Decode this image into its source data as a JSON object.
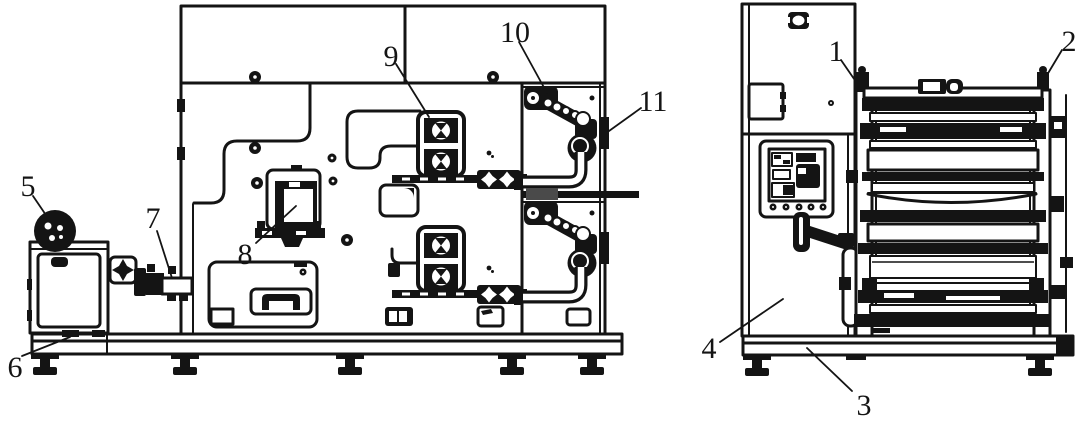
{
  "figure": {
    "type": "technical-line-drawing",
    "background": "#ffffff",
    "ink": "#141414",
    "callouts": {
      "c1": {
        "label": "1"
      },
      "c2": {
        "label": "2"
      },
      "c3": {
        "label": "3"
      },
      "c4": {
        "label": "4"
      },
      "c5": {
        "label": "5"
      },
      "c6": {
        "label": "6"
      },
      "c7": {
        "label": "7"
      },
      "c8": {
        "label": "8"
      },
      "c9": {
        "label": "9"
      },
      "c10": {
        "label": "10"
      },
      "c11": {
        "label": "11"
      }
    }
  }
}
